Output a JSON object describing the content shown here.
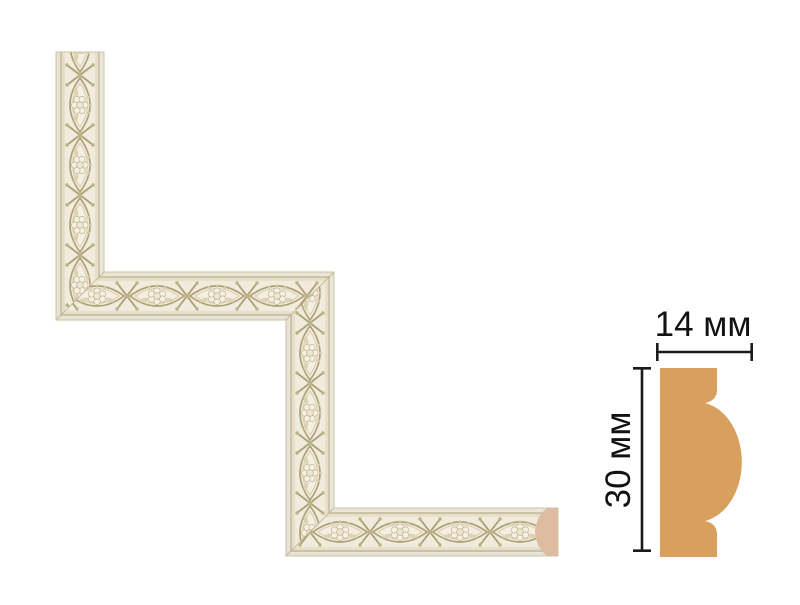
{
  "page": {
    "background_color": "#ffffff"
  },
  "molding_sample": {
    "base_color": "#F0EBDD",
    "ornament_color": "#AB9F74",
    "edge_highlight_color": "#F7F4EC",
    "edge_line_color": "#C8BD9C",
    "outline_color": "#CEC3A2",
    "seam_color": "#B7AB86",
    "end_cut_color": "#DDBCA0"
  },
  "profile_diagram": {
    "fill_color": "#D99F5E",
    "dimension_line_color": "#1a1a1a",
    "width_label": "14 мм",
    "height_label": "30 мм"
  }
}
